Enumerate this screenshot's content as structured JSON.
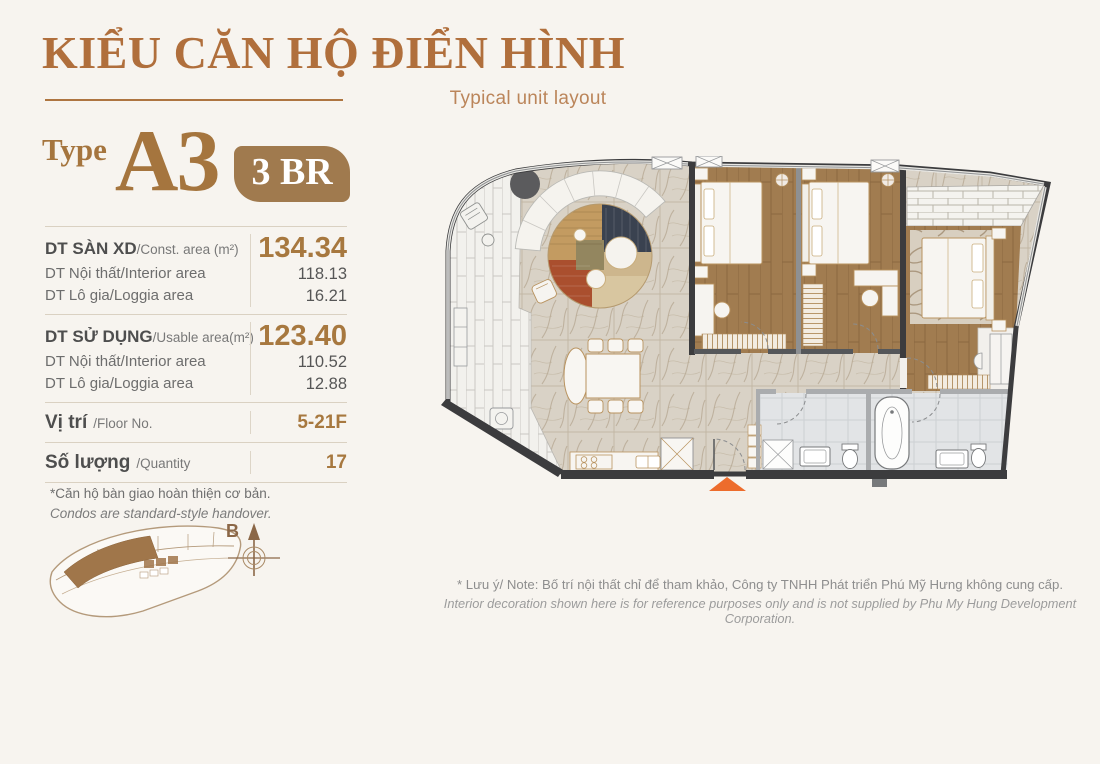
{
  "header": {
    "title_vi": "KIỂU CĂN HỘ ĐIỂN HÌNH",
    "subtitle_en": "Typical unit layout"
  },
  "unit": {
    "type_label": "Type",
    "type_code": "A3",
    "bedrooms_badge": "3 BR"
  },
  "specs": {
    "construction": {
      "label_vi": "DT SÀN XD",
      "label_en": "/Const. area (m²)",
      "value": "134.34",
      "interior": {
        "label": "DT Nội thất/Interior area",
        "value": "118.13"
      },
      "loggia": {
        "label": "DT Lô gia/Loggia area",
        "value": "16.21"
      }
    },
    "usable": {
      "label_vi": "DT SỬ DỤNG",
      "label_en": "/Usable area(m²)",
      "value": "123.40",
      "interior": {
        "label": "DT Nội thất/Interior area",
        "value": "110.52"
      },
      "loggia": {
        "label": "DT Lô gia/Loggia area",
        "value": "12.88"
      }
    },
    "floor": {
      "label_vi": "Vị trí",
      "label_en": "/Floor No.",
      "value": "5-21F"
    },
    "quantity": {
      "label_vi": "Số lượng",
      "label_en": "/Quantity",
      "value": "17"
    }
  },
  "handover_note": {
    "line_vi": "*Căn hộ bàn giao hoàn thiện cơ bản.",
    "line_en": "Condos are standard-style handover."
  },
  "key_plan": {
    "compass_label": "B"
  },
  "disclaimer": {
    "line_vi": "* Lưu ý/ Note: Bố trí nội thất chỉ để tham khảo, Công ty TNHH Phát triển Phú Mỹ Hưng không cung cấp.",
    "line_en": "Interior decoration shown here is for reference purposes only and is not supplied by Phu My Hung Development Corporation."
  },
  "colors": {
    "title_brown": "#b06f3c",
    "accent_brown": "#a7783f",
    "badge_bg": "#a07a4e",
    "orange_marker": "#ed6c2c",
    "wood": "#a17c50",
    "marble": "#d9d2c6",
    "highlight_unit": "#a0764a"
  }
}
